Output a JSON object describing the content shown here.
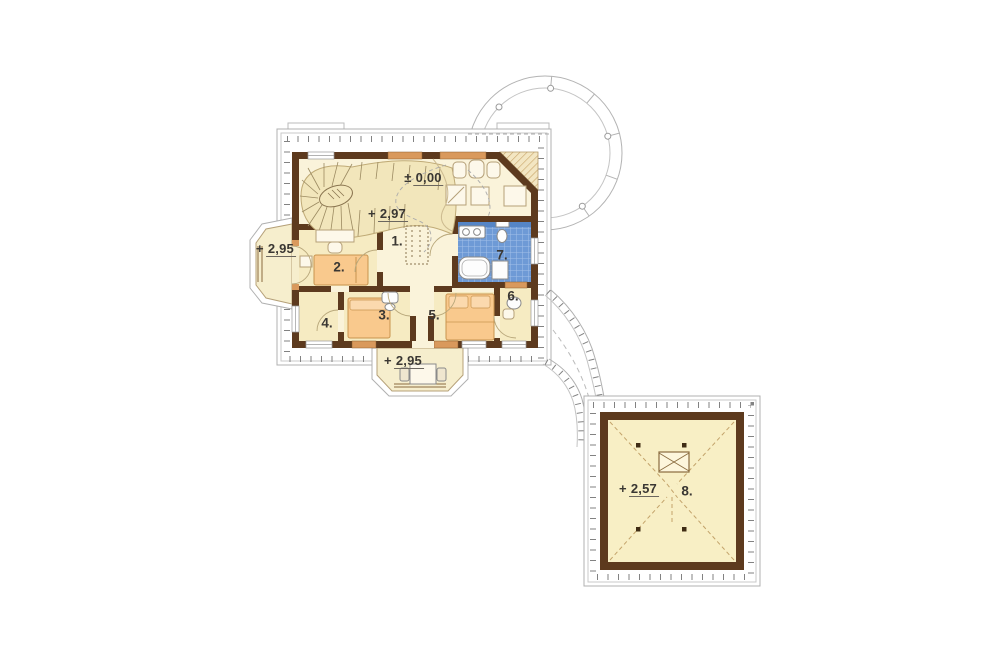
{
  "elevations": {
    "ground": {
      "sign": "±",
      "value": "0,00"
    },
    "landing": {
      "sign": "+",
      "value": "2,97"
    },
    "bay_left": {
      "sign": "+",
      "value": "2,95"
    },
    "bay_bottom": {
      "sign": "+",
      "value": "2,95"
    },
    "annex": {
      "sign": "+",
      "value": "2,57"
    }
  },
  "rooms": {
    "hall": "1.",
    "bedroom_left": "2.",
    "bedroom_mid": "3.",
    "room_small": "4.",
    "bedroom_big": "5.",
    "room_right": "6.",
    "bathroom": "7.",
    "annex": "8."
  },
  "colors": {
    "wall_brown": "#5d3a1e",
    "floor_hall": "#faf3da",
    "floor_room": "#f6ebc2",
    "floor_stairs": "#f2e6bb",
    "window_tan": "#d9995c",
    "tile_blue": "#6e9ad6",
    "furniture_orange": "#f9c98d",
    "eaves_gray": "#b0b0b0"
  }
}
